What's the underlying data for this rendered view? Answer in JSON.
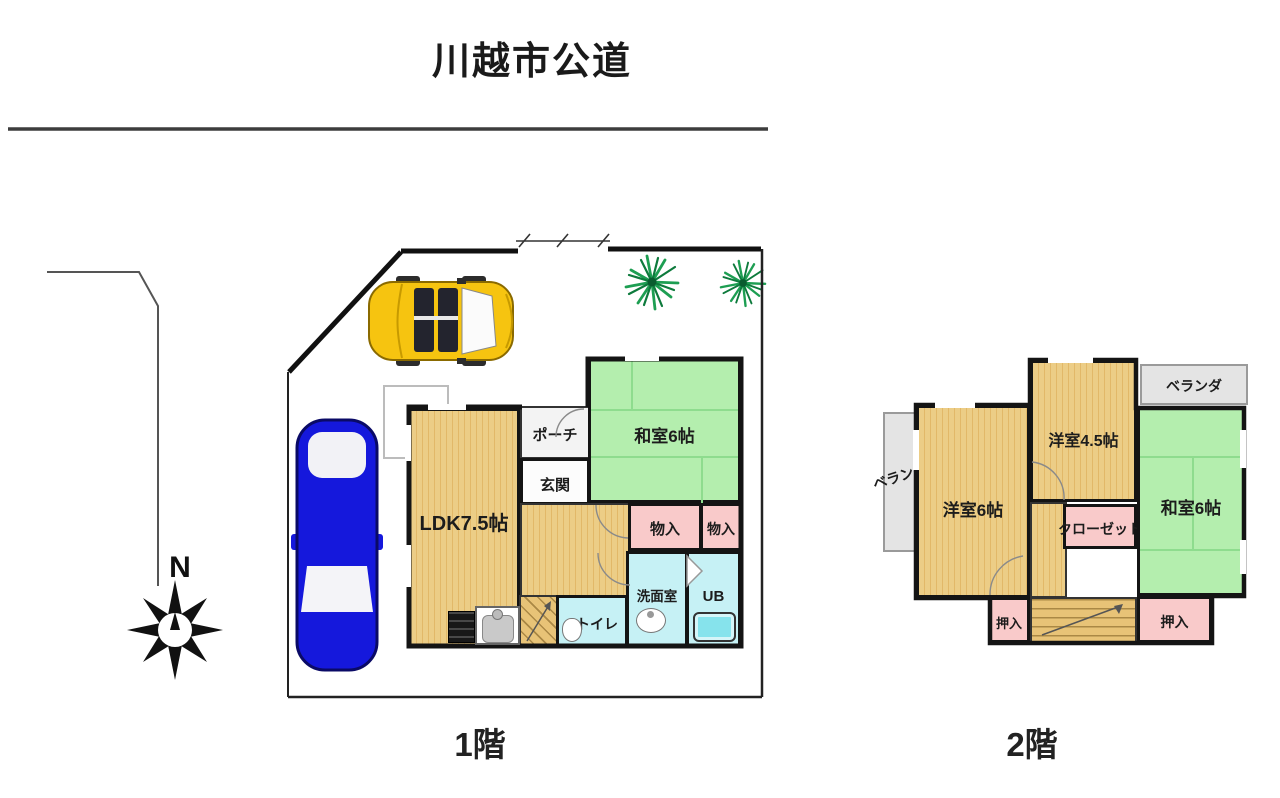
{
  "title": "川越市公道",
  "compass": {
    "north": "N"
  },
  "floor1": {
    "label": "1階",
    "washitsu": "和室6帖",
    "porch": "ポーチ",
    "genkan": "玄関",
    "ldk": "LDK7.5帖",
    "storage1": "物入",
    "storage2": "物入",
    "washroom": "洗面室",
    "bath": "UB",
    "toilet": "トイレ"
  },
  "floor2": {
    "label": "2階",
    "veranda_top": "ベランダ",
    "veranda_left": "ベランダ",
    "western6": "洋室6帖",
    "western45": "洋室4.5帖",
    "closet": "クローゼット",
    "washitsu": "和室6帖",
    "oshiire1": "押入",
    "oshiire2": "押入"
  },
  "colors": {
    "wood": "#e8c377",
    "wood_stripe": "#e2b868",
    "tatami_green": "#b4eeae",
    "tatami_line": "#8edc8e",
    "storage_pink": "#f9caca",
    "wet_cyan": "#c6f1f5",
    "veranda_gray": "#e4e4e4",
    "wall": "#141414",
    "road_line": "#3d3d3d",
    "car_yellow": "#f6c410",
    "car_blue": "#1518dc",
    "tree_green": "#1d9e52",
    "bathtub": "#86e3ec"
  }
}
